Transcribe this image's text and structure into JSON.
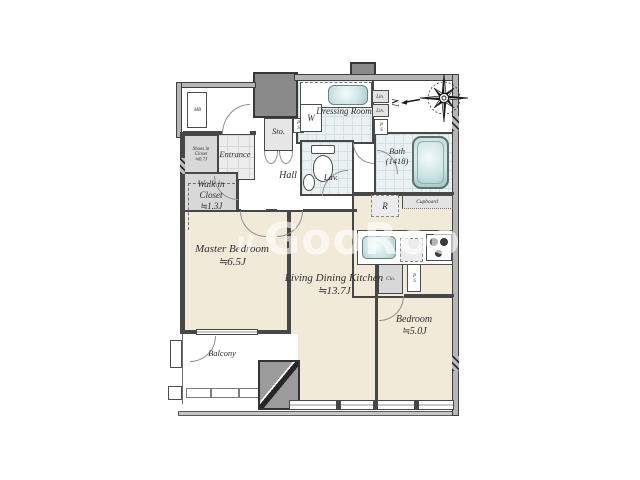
{
  "plan": {
    "rooms": {
      "master_bedroom": {
        "name": "Master Bedroom",
        "size": "≒6.5J"
      },
      "ldk": {
        "name": "Living Dining Kitchen",
        "size": "≒13.7J"
      },
      "bedroom": {
        "name": "Bedroom",
        "size": "≒5.0J"
      },
      "walk_in_closet": {
        "name": "Walk in Closet",
        "size": "≒1.3J"
      },
      "shoes_in_closet": {
        "name": "Shoes in Closet",
        "size": "≒0.7J"
      },
      "dressing_room": {
        "name": "Dressing Room"
      },
      "bath": {
        "name": "Bath",
        "size": "(1418)"
      },
      "lav": {
        "name": "Lav."
      },
      "hall": {
        "name": "Hall"
      },
      "entrance": {
        "name": "Entrance"
      },
      "balcony": {
        "name": "Balcony"
      },
      "storage": {
        "name": "Sto."
      },
      "meter_box": {
        "name": "MB"
      },
      "washer": {
        "name": "W"
      },
      "linen1": {
        "name": "Lin."
      },
      "linen2": {
        "name": "Lin."
      },
      "pipe_space_top": {
        "name": "PS"
      },
      "pipe_space_mid": {
        "name": "PS"
      },
      "pipe_space_kitchen": {
        "name": "PS"
      },
      "refrigerator": {
        "name": "R"
      },
      "cupboard": {
        "name": "Cupboard"
      },
      "closet": {
        "name": "Clo."
      }
    },
    "compass": {
      "label": "N"
    },
    "watermark": {
      "icon": "〃",
      "text": "GooRooM"
    }
  }
}
